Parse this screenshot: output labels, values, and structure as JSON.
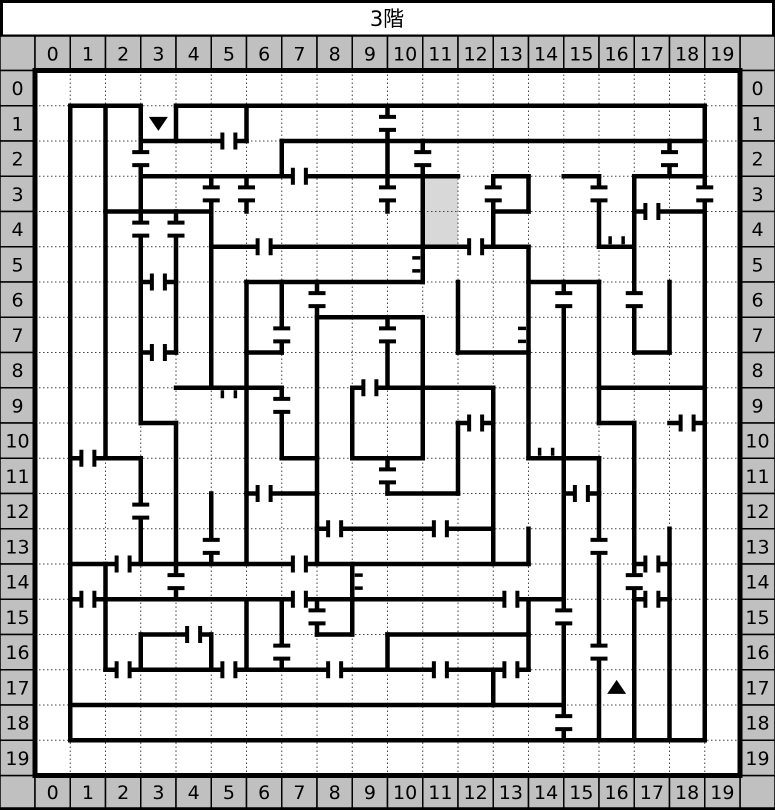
{
  "title": "3階",
  "col_headers": [
    "0",
    "1",
    "2",
    "3",
    "4",
    "5",
    "6",
    "7",
    "8",
    "9",
    "10",
    "11",
    "12",
    "13",
    "14",
    "15",
    "16",
    "17",
    "18",
    "19"
  ],
  "row_headers": [
    "0",
    "1",
    "2",
    "3",
    "4",
    "5",
    "6",
    "7",
    "8",
    "9",
    "10",
    "11",
    "12",
    "13",
    "14",
    "15",
    "16",
    "17",
    "18",
    "19"
  ],
  "colors": {
    "header_bg": "#c0c0c0",
    "wall": "#000000",
    "shaded_cell": "#d8d8d8",
    "grid_dot": "#444444",
    "background": "#ffffff",
    "marker": "#000000"
  },
  "map": {
    "cols": 20,
    "rows": 20,
    "outer_wall": true,
    "shaded_cells": [
      [
        11,
        3
      ],
      [
        11,
        4
      ]
    ],
    "markers": [
      {
        "cell": [
          3,
          1
        ],
        "glyph": "down-triangle",
        "name": "stairs-down"
      },
      {
        "cell": [
          16,
          17
        ],
        "glyph": "up-triangle",
        "name": "stairs-up"
      }
    ],
    "vwalls": [
      [
        1,
        1,
        19
      ],
      [
        2,
        1,
        11
      ],
      [
        2,
        14,
        17
      ],
      [
        3,
        1,
        10
      ],
      [
        3,
        11,
        14
      ],
      [
        3,
        16,
        17
      ],
      [
        4,
        1,
        2
      ],
      [
        4,
        4,
        8
      ],
      [
        4,
        10,
        15
      ],
      [
        5,
        3,
        9
      ],
      [
        5,
        12,
        14
      ],
      [
        5,
        16,
        17
      ],
      [
        6,
        1,
        2
      ],
      [
        6,
        3,
        4
      ],
      [
        6,
        6,
        14
      ],
      [
        6,
        15,
        17
      ],
      [
        7,
        2,
        3
      ],
      [
        7,
        6,
        8
      ],
      [
        7,
        9,
        11
      ],
      [
        7,
        15,
        17
      ],
      [
        8,
        6,
        14
      ],
      [
        8,
        15,
        16
      ],
      [
        9,
        9,
        11
      ],
      [
        9,
        14,
        16
      ],
      [
        10,
        1,
        4
      ],
      [
        10,
        7,
        9
      ],
      [
        10,
        11,
        12
      ],
      [
        10,
        16,
        17
      ],
      [
        11,
        2,
        6
      ],
      [
        11,
        7,
        11
      ],
      [
        12,
        6,
        8
      ],
      [
        12,
        10,
        12
      ],
      [
        13,
        3,
        5
      ],
      [
        13,
        9,
        14
      ],
      [
        13,
        17,
        18
      ],
      [
        14,
        3,
        4
      ],
      [
        14,
        5,
        11
      ],
      [
        14,
        13,
        14
      ],
      [
        14,
        15,
        17
      ],
      [
        15,
        6,
        19
      ],
      [
        16,
        3,
        5
      ],
      [
        16,
        6,
        10
      ],
      [
        16,
        11,
        19
      ],
      [
        17,
        3,
        8
      ],
      [
        17,
        10,
        19
      ],
      [
        18,
        2,
        3
      ],
      [
        18,
        6,
        8
      ],
      [
        18,
        13,
        19
      ],
      [
        19,
        1,
        19
      ]
    ],
    "hwalls": [
      [
        1,
        1,
        3
      ],
      [
        1,
        4,
        19
      ],
      [
        2,
        3,
        6
      ],
      [
        2,
        7,
        19
      ],
      [
        3,
        3,
        12
      ],
      [
        3,
        13,
        14
      ],
      [
        3,
        15,
        16
      ],
      [
        3,
        17,
        19
      ],
      [
        4,
        2,
        5
      ],
      [
        4,
        13,
        14
      ],
      [
        4,
        17,
        19
      ],
      [
        5,
        5,
        14
      ],
      [
        5,
        16,
        17
      ],
      [
        6,
        3,
        4
      ],
      [
        6,
        6,
        11
      ],
      [
        6,
        14,
        16
      ],
      [
        7,
        8,
        11
      ],
      [
        8,
        3,
        4
      ],
      [
        8,
        6,
        7
      ],
      [
        8,
        12,
        14
      ],
      [
        8,
        17,
        18
      ],
      [
        9,
        4,
        7
      ],
      [
        9,
        9,
        13
      ],
      [
        9,
        16,
        19
      ],
      [
        10,
        3,
        4
      ],
      [
        10,
        12,
        13
      ],
      [
        10,
        16,
        17
      ],
      [
        10,
        18,
        19
      ],
      [
        11,
        1,
        3
      ],
      [
        11,
        7,
        8
      ],
      [
        11,
        9,
        11
      ],
      [
        11,
        14,
        16
      ],
      [
        12,
        6,
        8
      ],
      [
        12,
        10,
        12
      ],
      [
        12,
        15,
        16
      ],
      [
        13,
        8,
        13
      ],
      [
        14,
        1,
        14
      ],
      [
        14,
        17,
        18
      ],
      [
        15,
        1,
        15
      ],
      [
        15,
        17,
        18
      ],
      [
        16,
        3,
        5
      ],
      [
        16,
        8,
        9
      ],
      [
        16,
        10,
        14
      ],
      [
        17,
        2,
        14
      ],
      [
        18,
        1,
        15
      ],
      [
        19,
        1,
        19
      ]
    ],
    "doors": [
      {
        "o": "v",
        "x": 3,
        "r": 2,
        "t": "full"
      },
      {
        "o": "v",
        "x": 3,
        "r": 4,
        "t": "full"
      },
      {
        "o": "v",
        "x": 3,
        "r": 12,
        "t": "full"
      },
      {
        "o": "v",
        "x": 4,
        "r": 4,
        "t": "full"
      },
      {
        "o": "v",
        "x": 4,
        "r": 14,
        "t": "full"
      },
      {
        "o": "v",
        "x": 5,
        "r": 3,
        "t": "full"
      },
      {
        "o": "v",
        "x": 5,
        "r": 13,
        "t": "full"
      },
      {
        "o": "v",
        "x": 6,
        "r": 3,
        "t": "full"
      },
      {
        "o": "v",
        "x": 7,
        "r": 7,
        "t": "full"
      },
      {
        "o": "v",
        "x": 7,
        "r": 9,
        "t": "full"
      },
      {
        "o": "v",
        "x": 7,
        "r": 16,
        "t": "full"
      },
      {
        "o": "v",
        "x": 8,
        "r": 6,
        "t": "full"
      },
      {
        "o": "v",
        "x": 8,
        "r": 15,
        "t": "full"
      },
      {
        "o": "v",
        "x": 10,
        "r": 1,
        "t": "full"
      },
      {
        "o": "v",
        "x": 10,
        "r": 3,
        "t": "full"
      },
      {
        "o": "v",
        "x": 10,
        "r": 7,
        "t": "full"
      },
      {
        "o": "v",
        "x": 10,
        "r": 11,
        "t": "full"
      },
      {
        "o": "v",
        "x": 11,
        "r": 2,
        "t": "full"
      },
      {
        "o": "v",
        "x": 13,
        "r": 3,
        "t": "full"
      },
      {
        "o": "v",
        "x": 15,
        "r": 6,
        "t": "full"
      },
      {
        "o": "v",
        "x": 15,
        "r": 15,
        "t": "full"
      },
      {
        "o": "v",
        "x": 15,
        "r": 18,
        "t": "full"
      },
      {
        "o": "v",
        "x": 16,
        "r": 3,
        "t": "full"
      },
      {
        "o": "v",
        "x": 16,
        "r": 13,
        "t": "full"
      },
      {
        "o": "v",
        "x": 16,
        "r": 16,
        "t": "full"
      },
      {
        "o": "v",
        "x": 17,
        "r": 6,
        "t": "full"
      },
      {
        "o": "v",
        "x": 17,
        "r": 14,
        "t": "full"
      },
      {
        "o": "v",
        "x": 18,
        "r": 2,
        "t": "full"
      },
      {
        "o": "v",
        "x": 19,
        "r": 3,
        "t": "full"
      },
      {
        "o": "h",
        "y": 2,
        "c": 5,
        "t": "full"
      },
      {
        "o": "h",
        "y": 3,
        "c": 7,
        "t": "full"
      },
      {
        "o": "h",
        "y": 4,
        "c": 17,
        "t": "full"
      },
      {
        "o": "h",
        "y": 5,
        "c": 6,
        "t": "full"
      },
      {
        "o": "h",
        "y": 5,
        "c": 12,
        "t": "full"
      },
      {
        "o": "h",
        "y": 6,
        "c": 3,
        "t": "full"
      },
      {
        "o": "h",
        "y": 8,
        "c": 3,
        "t": "full"
      },
      {
        "o": "h",
        "y": 9,
        "c": 9,
        "t": "full"
      },
      {
        "o": "h",
        "y": 10,
        "c": 12,
        "t": "full"
      },
      {
        "o": "h",
        "y": 10,
        "c": 18,
        "t": "full"
      },
      {
        "o": "h",
        "y": 11,
        "c": 1,
        "t": "full"
      },
      {
        "o": "h",
        "y": 12,
        "c": 6,
        "t": "full"
      },
      {
        "o": "h",
        "y": 12,
        "c": 15,
        "t": "full"
      },
      {
        "o": "h",
        "y": 13,
        "c": 8,
        "t": "full"
      },
      {
        "o": "h",
        "y": 13,
        "c": 11,
        "t": "full"
      },
      {
        "o": "h",
        "y": 14,
        "c": 2,
        "t": "full"
      },
      {
        "o": "h",
        "y": 14,
        "c": 7,
        "t": "full"
      },
      {
        "o": "h",
        "y": 14,
        "c": 17,
        "t": "full"
      },
      {
        "o": "h",
        "y": 15,
        "c": 1,
        "t": "full"
      },
      {
        "o": "h",
        "y": 15,
        "c": 7,
        "t": "full"
      },
      {
        "o": "h",
        "y": 15,
        "c": 13,
        "t": "full"
      },
      {
        "o": "h",
        "y": 15,
        "c": 17,
        "t": "full"
      },
      {
        "o": "h",
        "y": 16,
        "c": 4,
        "t": "full"
      },
      {
        "o": "h",
        "y": 17,
        "c": 2,
        "t": "full"
      },
      {
        "o": "h",
        "y": 17,
        "c": 5,
        "t": "full"
      },
      {
        "o": "h",
        "y": 17,
        "c": 8,
        "t": "full"
      },
      {
        "o": "h",
        "y": 17,
        "c": 11,
        "t": "full"
      },
      {
        "o": "h",
        "y": 17,
        "c": 13,
        "t": "full"
      },
      {
        "o": "h",
        "y": 5,
        "c": 16,
        "t": "half",
        "side": "up"
      },
      {
        "o": "h",
        "y": 9,
        "c": 5,
        "t": "half",
        "side": "down"
      },
      {
        "o": "h",
        "y": 11,
        "c": 14,
        "t": "half",
        "side": "up"
      },
      {
        "o": "v",
        "x": 11,
        "r": 5,
        "t": "half",
        "side": "left"
      },
      {
        "o": "v",
        "x": 14,
        "r": 7,
        "t": "half",
        "side": "left"
      },
      {
        "o": "v",
        "x": 9,
        "r": 14,
        "t": "half",
        "side": "right"
      }
    ]
  }
}
